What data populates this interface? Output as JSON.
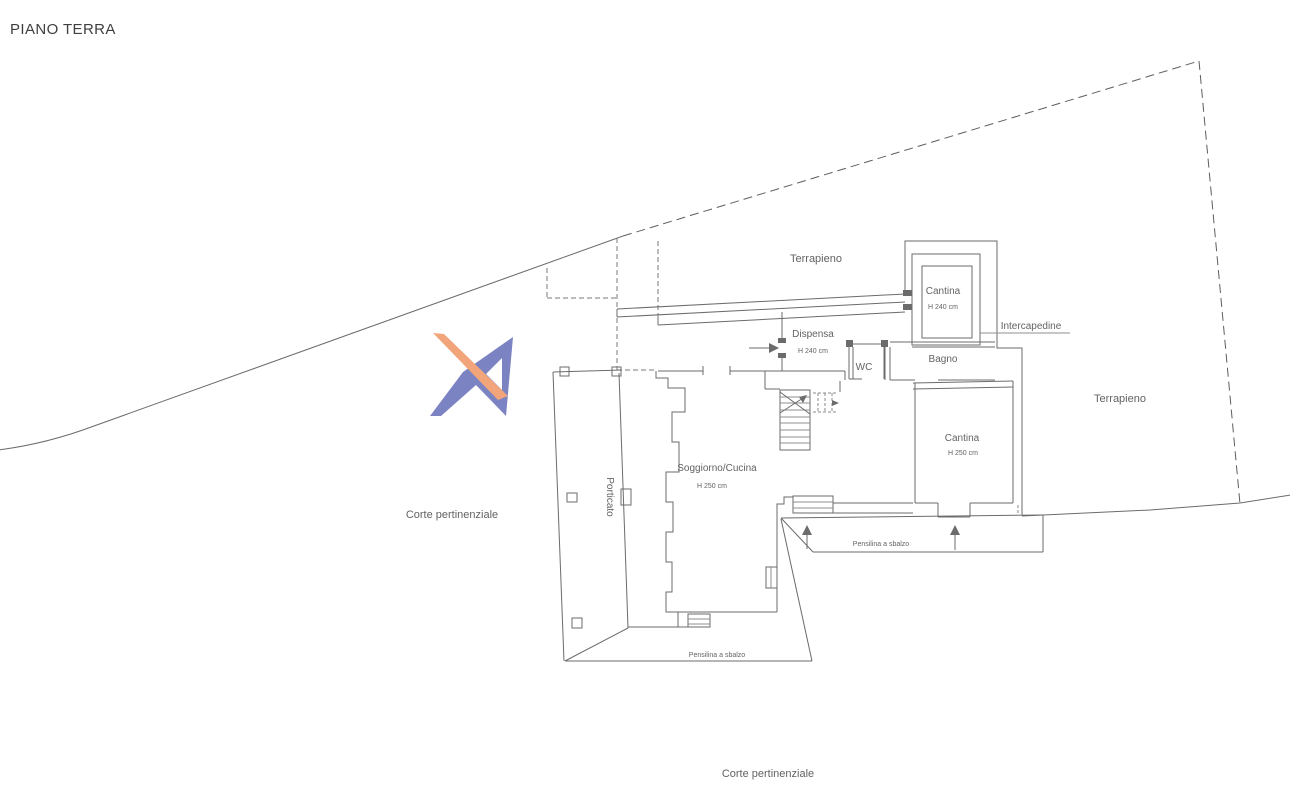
{
  "title": "PIANO TERRA",
  "areas": {
    "terrapieno_top": "Terrapieno",
    "terrapieno_right": "Terrapieno",
    "corte_pertinenziale_left": "Corte pertinenziale",
    "corte_pertinenziale_bottom": "Corte pertinenziale",
    "porticato": "Porticato"
  },
  "rooms": {
    "cantina_upper": {
      "name": "Cantina",
      "height": "H 240 cm"
    },
    "dispensa": {
      "name": "Dispensa",
      "height": "H 240 cm"
    },
    "wc": {
      "name": "WC"
    },
    "bagno": {
      "name": "Bagno"
    },
    "intercapedine": {
      "name": "Intercapedine"
    },
    "cantina_lower": {
      "name": "Cantina",
      "height": "H 250 cm"
    },
    "soggiorno_cucina": {
      "name": "Soggiorno/Cucina",
      "height": "H 250 cm"
    }
  },
  "canopies": {
    "pensilina_right": "Pensilina a sbalzo",
    "pensilina_bottom": "Pensilina a sbalzo"
  },
  "colors": {
    "background": "#ffffff",
    "wall_line": "#6b6b6b",
    "light_line": "#8f8f8f",
    "text": "#636363",
    "title_text": "#3f3f3f",
    "logo_blue": "#7b83c2",
    "logo_orange": "#f2a57a"
  }
}
